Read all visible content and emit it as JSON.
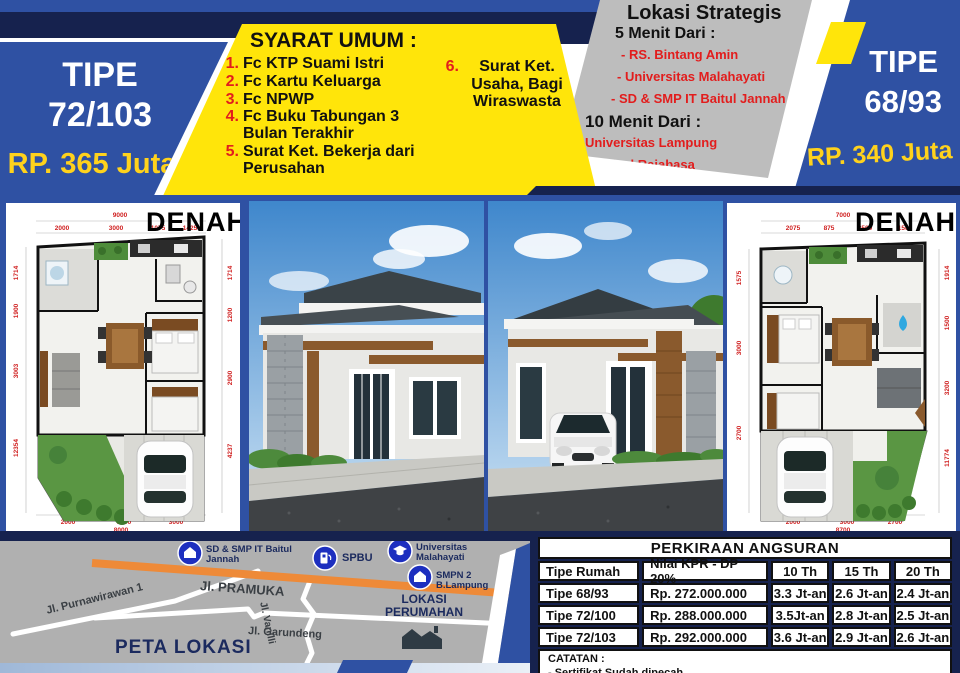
{
  "colors": {
    "royal_blue": "#2f51a3",
    "navy": "#16224e",
    "yellow": "#ffe50a",
    "gold": "#ffd21c",
    "red": "#e21d1d",
    "gray_panel": "#bdbdbd",
    "map_gray": "#b0b0b0",
    "road_orange": "#ee8a38",
    "marker_blue": "#1d2fbf"
  },
  "header": {
    "left_badge": {
      "line1": "TIPE",
      "line2": "72/103",
      "price": "RP. 365 Juta"
    },
    "right_badge": {
      "line1": "TIPE",
      "line2": "68/93",
      "price": "RP. 340 Juta"
    },
    "syarat": {
      "title": "SYARAT UMUM :",
      "items": [
        {
          "num": "1.",
          "text": "Fc KTP Suami Istri"
        },
        {
          "num": "2.",
          "text": "Fc Kartu Keluarga"
        },
        {
          "num": "3.",
          "text": "Fc NPWP"
        },
        {
          "num": "4.",
          "text": "Fc Buku Tabungan 3 Bulan Terakhir"
        },
        {
          "num": "5.",
          "text": "Surat Ket. Bekerja dari Perusahan"
        }
      ],
      "item6_num": "6.",
      "item6_text": "Surat Ket. Usaha, Bagi Wiraswasta"
    },
    "lokasi": {
      "title": "Lokasi Strategis",
      "group1_title": "5 Menit Dari :",
      "group1_items": [
        "- RS. Bintang Amin",
        "- Universitas Malahayati",
        "- SD & SMP IT Baitul Jannah"
      ],
      "group2_title": "10 Menit Dari :",
      "group2_items": [
        "- Universitas Lampung",
        "- Terminal Rajabasa"
      ]
    }
  },
  "plans": {
    "left": {
      "label": "DENAH",
      "top_total": "9000",
      "top": [
        "2000",
        "3000",
        "1075",
        "1425"
      ],
      "left": [
        "1714",
        "1900",
        "3003",
        "12354"
      ],
      "right": [
        "1714",
        "1200",
        "2900",
        "4237"
      ],
      "bottom": [
        "2000",
        "3000",
        "3000"
      ],
      "bottom_total": "8000"
    },
    "right": {
      "label": "DENAH",
      "top_total": "7000",
      "top": [
        "2075",
        "875",
        "2500",
        "1500"
      ],
      "left": [
        "1575",
        "3000",
        "2700"
      ],
      "right": [
        "1914",
        "1500",
        "3200",
        "11774"
      ],
      "bottom": [
        "2000",
        "3000",
        "2700"
      ],
      "bottom_total": "8700"
    }
  },
  "map": {
    "title": "PETA LOKASI",
    "location_label": "LOKASI PERUMAHAN",
    "streets": {
      "pramuka": "Jl. PRAMUKA",
      "purnawirawan": "Jl. Purnawirawan 1",
      "garundeng": "Jl. Garundeng",
      "vanilli": "Jl. Vanilli"
    },
    "markers": [
      {
        "icon": "school-icon",
        "label": "SD & SMP IT Baitul Jannah"
      },
      {
        "icon": "fuel-pump-icon",
        "label": "SPBU"
      },
      {
        "icon": "university-icon",
        "label": "Universitas Malahayati"
      },
      {
        "icon": "school-icon",
        "label": "SMPN 2 B.Lampung"
      }
    ]
  },
  "installments": {
    "title": "PERKIRAAN ANGSURAN",
    "headers": [
      "Tipe Rumah",
      "Nilai KPR - DP 20%",
      "10 Th",
      "15 Th",
      "20 Th"
    ],
    "rows": [
      [
        "Tipe 68/93",
        "Rp. 272.000.000",
        "3.3 Jt-an",
        "2.6 Jt-an",
        "2.4 Jt-an"
      ],
      [
        "Tipe 72/100",
        "Rp. 288.000.000",
        "3.5Jt-an",
        "2.8 Jt-an",
        "2.5 Jt-an"
      ],
      [
        "Tipe 72/103",
        "Rp. 292.000.000",
        "3.6 Jt-an",
        "2.9 Jt-an",
        "2.6 Jt-an"
      ]
    ],
    "note_title": "CATATAN :",
    "note": "- Sertifikat Sudah dipecah"
  }
}
